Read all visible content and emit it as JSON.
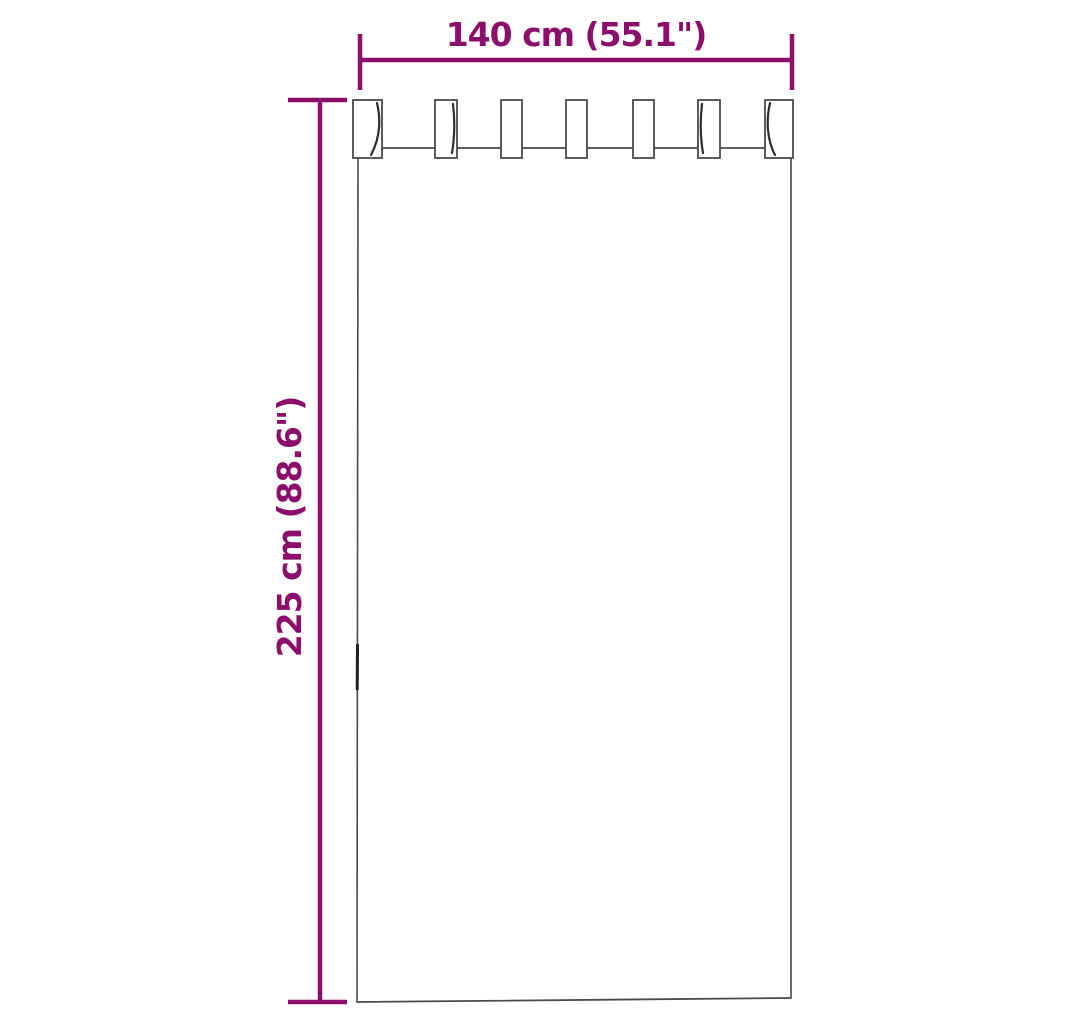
{
  "diagram": {
    "width_label": "140 cm (55.1\")",
    "height_label": "225 cm (88.6\")",
    "accent_color": "#8B0E6B",
    "outline_color": "#4A4A4A",
    "background_color": "#FFFFFF",
    "tab_count": "7"
  }
}
